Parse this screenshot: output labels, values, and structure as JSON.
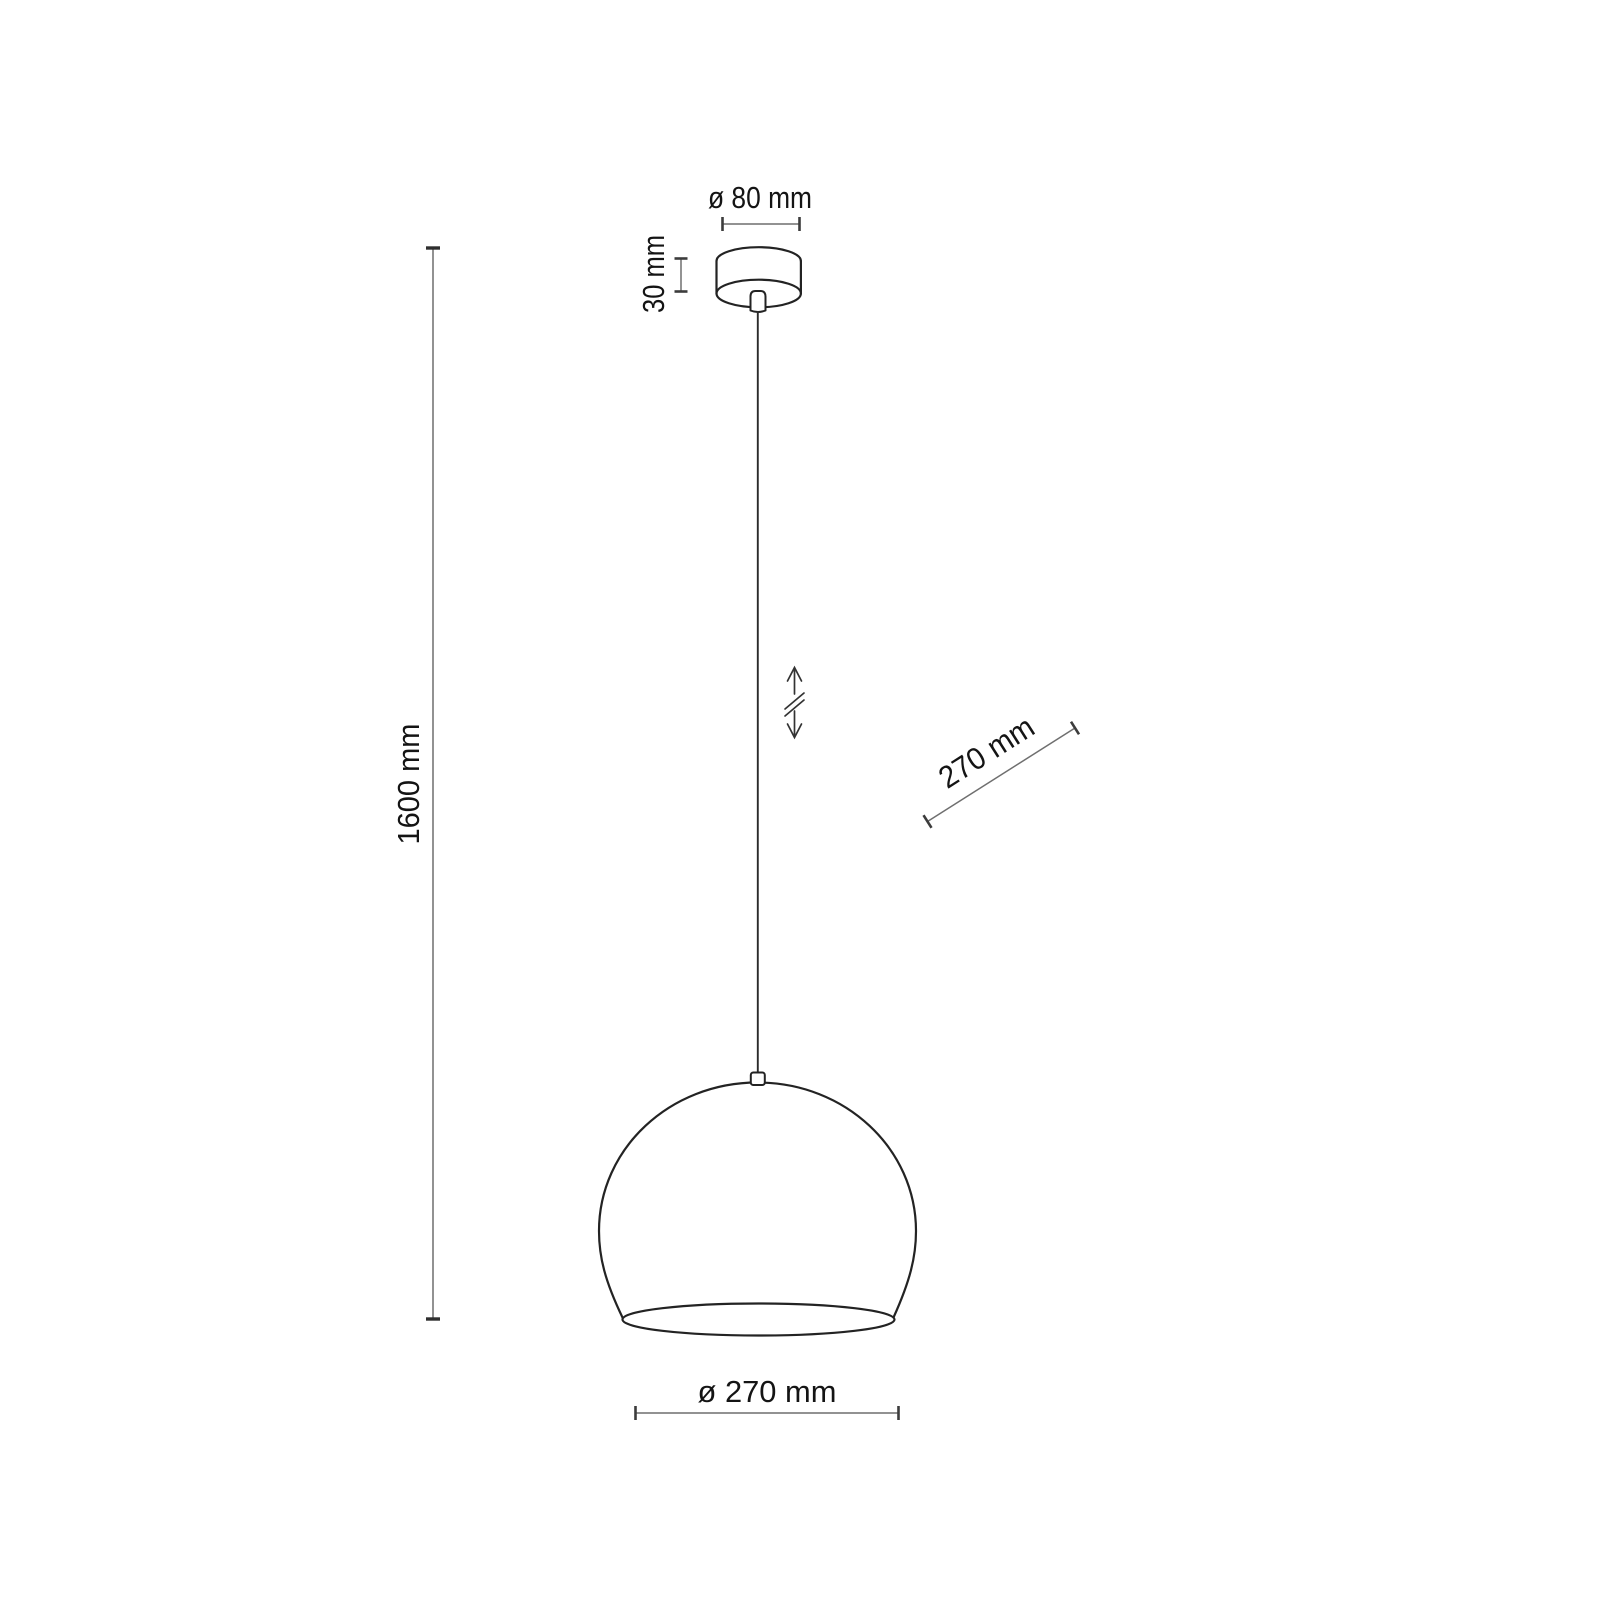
{
  "diagram": {
    "kind": "pendant-lamp-dimension-drawing",
    "labels": {
      "canopy_diameter": "ø 80 mm",
      "canopy_height": "30 mm",
      "total_height": "1600 mm",
      "shade_side_diameter": "270 mm",
      "shade_bottom_diameter": "ø 270 mm"
    },
    "icons": {
      "height_adjustable": "vertical-double-arrow-with-break"
    },
    "colors": {
      "background": "#ffffff",
      "outline": "#232323",
      "dimension_line": "#6f6f6f",
      "tick": "#3c3c3c",
      "text": "#141414"
    }
  }
}
